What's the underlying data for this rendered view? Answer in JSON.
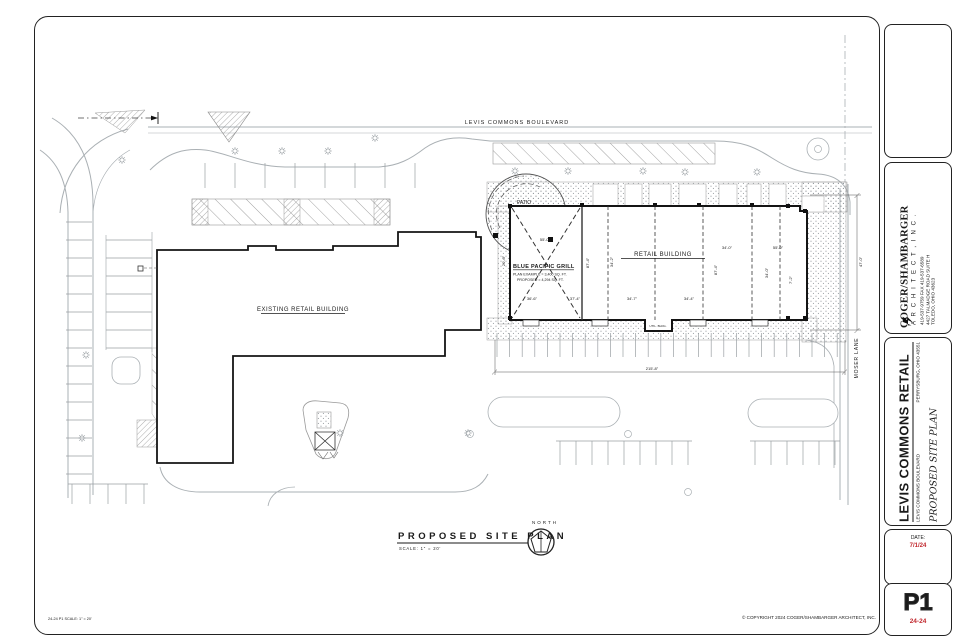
{
  "colors": {
    "accent_red": "#c1272d",
    "ink": "#1a1a1a",
    "curb_gray": "#a9aeb2"
  },
  "sheet": {
    "firm": {
      "name": "COGER/SHAMBARGER",
      "type": "A R C H I T E C T ,   I N C .",
      "phone": "419-537-9759    FAX  419-537-6589",
      "address": "4427 TALMADGE ROAD SUITE H",
      "city": "TOLEDO, OHIO  43623"
    },
    "project": {
      "title": "LEVIS COMMONS RETAIL",
      "address": "LEVIS COMMONS BOULEVARD",
      "city": "PERRYSBURG, OHIO  43551",
      "sheet_title": "PROPOSED SITE PLAN"
    },
    "date_label": "DATE:",
    "date": "7/1/24",
    "sheet_no": "P1",
    "job_no": "24-24"
  },
  "plan": {
    "street_top": "LEVIS COMMONS BOULEVARD",
    "street_right": "MOSER LANE",
    "existing_building": "EXISTING RETAIL BUILDING",
    "retail_building": "RETAIL BUILDING",
    "patio": "PATIO",
    "grill_name": "BLUE PACIFIC GRILL",
    "grill_line1": "PLAN EXAMPLE = 3,400 SQ. FT.",
    "grill_line2": "PROPOSED = 4,294 SQ. FT.",
    "util": "UTIL. BLDG.",
    "north": "NORTH",
    "dims": [
      "55'-0\"",
      "20'-0\"",
      "87'-4\"",
      "34'-2\"",
      "34'-0\"",
      "55'-0\"",
      "87'-4\"",
      "34'-0\"",
      "7'-2\"",
      "36'-6\"",
      "37'-4\"",
      "34'-7\"",
      "34'-4\"",
      "215'-8\"",
      "47'-0\""
    ]
  },
  "footer": {
    "title": "PROPOSED SITE PLAN",
    "scale": "SCALE:   1\" = 20'",
    "plot_stamp": "24-24 P1        SCALE: 1\" = 20'",
    "copyright": "© COPYRIGHT 2024 COGER/SHAMBARGER ARCHITECT, INC."
  }
}
